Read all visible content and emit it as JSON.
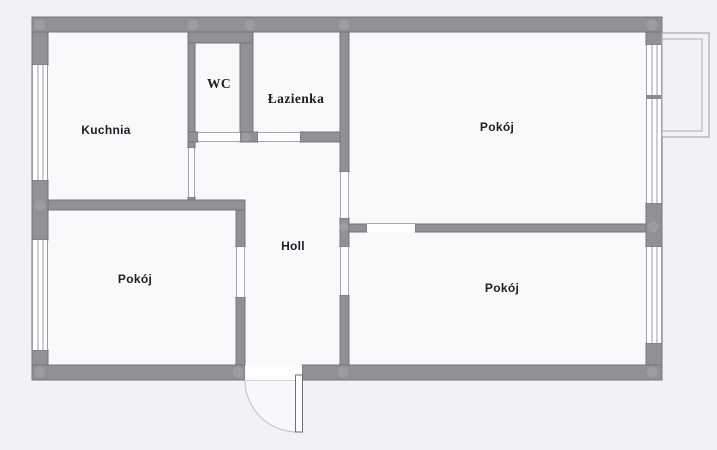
{
  "plan": {
    "rooms": [
      {
        "id": "kuchnia",
        "label": "Kuchnia"
      },
      {
        "id": "wc",
        "label": "WC"
      },
      {
        "id": "lazienka",
        "label": "Łazienka"
      },
      {
        "id": "pokoj-top-right",
        "label": "Pokój"
      },
      {
        "id": "pokoj-bottom-left",
        "label": "Pokój"
      },
      {
        "id": "pokoj-bottom-right",
        "label": "Pokój"
      },
      {
        "id": "holl",
        "label": "Holl"
      }
    ],
    "colors": {
      "background": "#f1f2f7",
      "room_fill": "#f8f9fb",
      "wall": "#909196",
      "wall_edge": "#6f7076",
      "window_line": "#9b9ca4",
      "balcony_line": "#a8a9b1",
      "door_swing_arc": "#c8c9d0",
      "label_text": "#1e1e20"
    }
  }
}
